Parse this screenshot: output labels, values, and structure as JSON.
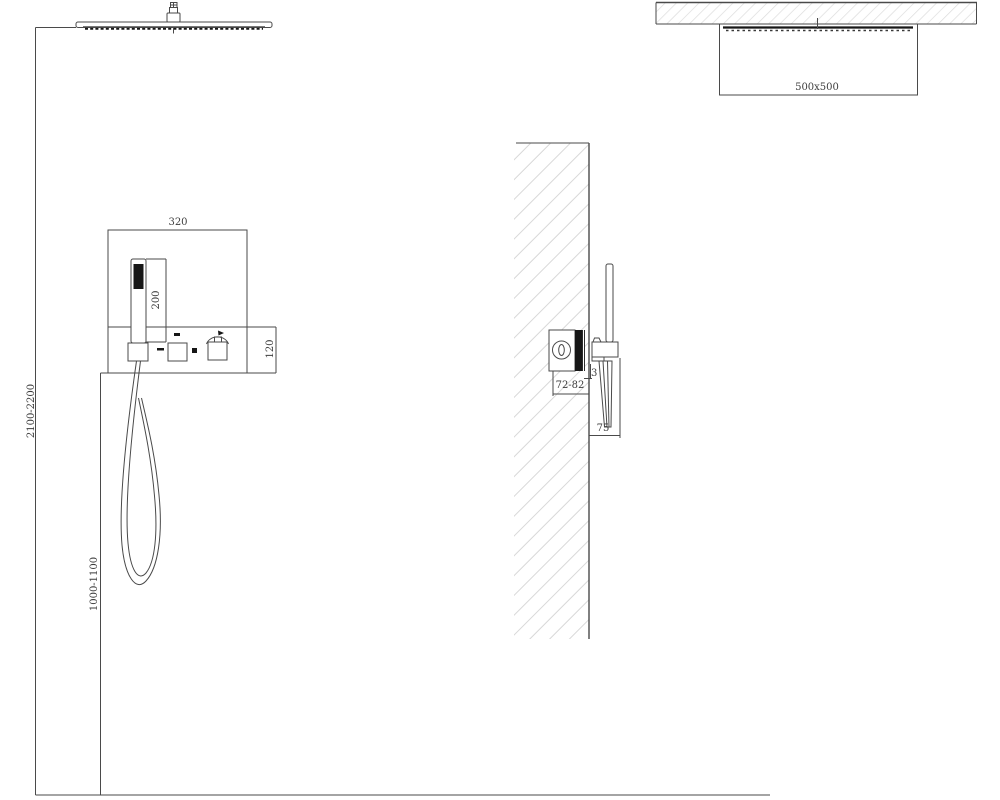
{
  "document": {
    "kind": "technical installation drawing",
    "subject": "concealed shower system with ceiling rain head, hand shower and in-wall mixer"
  },
  "colors": {
    "line": "#4a4a4a",
    "dark_fill": "#161616",
    "hatch": "#d8d8d8",
    "background": "#ffffff",
    "label_text": "#3d3d3d"
  },
  "front_view": {
    "dimensions": {
      "panel_width": "320",
      "hand_shower_height": "200",
      "panel_height": "120",
      "rain_head_mounting_height": "2100-2200",
      "control_panel_mounting_height": "1000-1100"
    }
  },
  "side_view": {
    "dimensions": {
      "rain_head_size": "500x500",
      "rough_in_depth_range": "72-82",
      "trim_plate_thickness": "3",
      "handle_projection": "75"
    }
  }
}
